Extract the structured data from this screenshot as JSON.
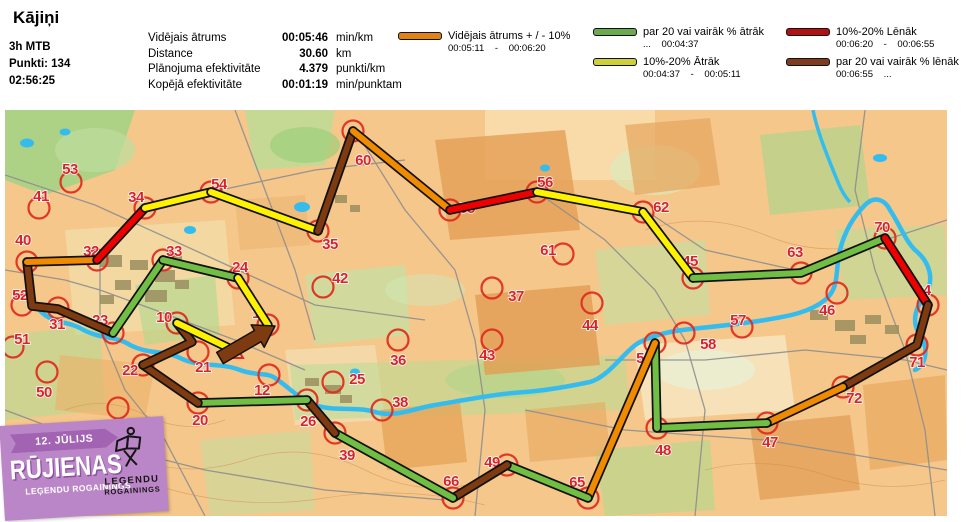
{
  "header": {
    "title": "Kājiņi",
    "class_label": "3h MTB",
    "points_label": "Punkti: 134",
    "time_label": "02:56:25",
    "stats": [
      {
        "label": "Vidējais ātrums",
        "value": "00:05:46",
        "unit": "min/km"
      },
      {
        "label": "Distance",
        "value": "30.60",
        "unit": "km"
      },
      {
        "label": "Plānojuma efektivitāte",
        "value": "4.379",
        "unit": "punkti/km"
      },
      {
        "label": "Kopējā efektivitāte",
        "value": "00:01:19",
        "unit": "min/punktam"
      }
    ]
  },
  "legend": {
    "items": [
      {
        "color": "#e08214",
        "label": "Vidējais ātrums + / - 10%",
        "range": "00:05:11 - 00:06:20"
      },
      {
        "color": "#6ca94f",
        "label": "par 20 vai vairāk % ātrāk",
        "range": "... 00:04:37"
      },
      {
        "color": "#cfcf3a",
        "label": "10%-20% Ātrāk",
        "range": "00:04:37 - 00:05:11"
      },
      {
        "color": "#b01212",
        "label": "10%-20% Lēnāk",
        "range": "00:06:20 - 00:06:55"
      },
      {
        "color": "#7e3b1e",
        "label": "par 20 vai vairāk % lēnāk",
        "range": "00:06:55 ..."
      }
    ]
  },
  "logo": {
    "date": "12. JŪLIJS",
    "title": "RŪJIENAS",
    "subtitle": "LEĢENDU ROGAININGS",
    "badge_line1": "LEĢENDU",
    "badge_line2": "ROGAININGS"
  },
  "map": {
    "colors": {
      "orange": "#f08a00",
      "green": "#70be44",
      "yellow": "#fff200",
      "red": "#ee0000",
      "brown": "#7e3a10"
    },
    "checkpoints": [
      {
        "n": "1",
        "cx": 263,
        "cy": 215,
        "lx": 251,
        "ly": 208
      },
      {
        "n": "10",
        "cx": 172,
        "cy": 213,
        "lx": 159,
        "ly": 212
      },
      {
        "n": "12",
        "cx": 264,
        "cy": 265,
        "lx": 257,
        "ly": 285
      },
      {
        "n": "20",
        "cx": 193,
        "cy": 293,
        "lx": 195,
        "ly": 315
      },
      {
        "n": "21",
        "cx": 193,
        "cy": 242,
        "lx": 198,
        "ly": 262
      },
      {
        "n": "22",
        "cx": 138,
        "cy": 255,
        "lx": 125,
        "ly": 265
      },
      {
        "n": "23",
        "cx": 108,
        "cy": 223,
        "lx": 95,
        "ly": 215
      },
      {
        "n": "24",
        "cx": 233,
        "cy": 168,
        "lx": 235,
        "ly": 162
      },
      {
        "n": "25",
        "cx": 328,
        "cy": 272,
        "lx": 352,
        "ly": 274
      },
      {
        "n": "26",
        "cx": 302,
        "cy": 290,
        "lx": 303,
        "ly": 316
      },
      {
        "n": "30",
        "cx": 113,
        "cy": 298,
        "lx": 116,
        "ly": 322
      },
      {
        "n": "31",
        "cx": 53,
        "cy": 198,
        "lx": 52,
        "ly": 219
      },
      {
        "n": "32",
        "cx": 92,
        "cy": 150,
        "lx": 86,
        "ly": 146
      },
      {
        "n": "33",
        "cx": 158,
        "cy": 150,
        "lx": 169,
        "ly": 146
      },
      {
        "n": "34",
        "cx": 140,
        "cy": 98,
        "lx": 131,
        "ly": 92
      },
      {
        "n": "35",
        "cx": 313,
        "cy": 121,
        "lx": 325,
        "ly": 139
      },
      {
        "n": "36",
        "cx": 393,
        "cy": 230,
        "lx": 393,
        "ly": 255
      },
      {
        "n": "37",
        "cx": 487,
        "cy": 178,
        "lx": 511,
        "ly": 191
      },
      {
        "n": "38",
        "cx": 377,
        "cy": 300,
        "lx": 395,
        "ly": 297
      },
      {
        "n": "39",
        "cx": 330,
        "cy": 323,
        "lx": 342,
        "ly": 350
      },
      {
        "n": "40",
        "cx": 22,
        "cy": 152,
        "lx": 18,
        "ly": 135
      },
      {
        "n": "41",
        "cx": 34,
        "cy": 98,
        "lx": 36,
        "ly": 91
      },
      {
        "n": "42",
        "cx": 318,
        "cy": 177,
        "lx": 335,
        "ly": 173
      },
      {
        "n": "43",
        "cx": 487,
        "cy": 230,
        "lx": 482,
        "ly": 250
      },
      {
        "n": "44",
        "cx": 587,
        "cy": 193,
        "lx": 585,
        "ly": 220
      },
      {
        "n": "45",
        "cx": 688,
        "cy": 168,
        "lx": 685,
        "ly": 156
      },
      {
        "n": "46",
        "cx": 832,
        "cy": 183,
        "lx": 822,
        "ly": 205
      },
      {
        "n": "47",
        "cx": 762,
        "cy": 313,
        "lx": 765,
        "ly": 337
      },
      {
        "n": "48",
        "cx": 652,
        "cy": 318,
        "lx": 658,
        "ly": 345
      },
      {
        "n": "49",
        "cx": 502,
        "cy": 355,
        "lx": 487,
        "ly": 357
      },
      {
        "n": "50",
        "cx": 42,
        "cy": 262,
        "lx": 39,
        "ly": 287
      },
      {
        "n": "51",
        "cx": 8,
        "cy": 237,
        "lx": 17,
        "ly": 234
      },
      {
        "n": "52",
        "cx": 17,
        "cy": 195,
        "lx": 15,
        "ly": 190
      },
      {
        "n": "53",
        "cx": 66,
        "cy": 72,
        "lx": 65,
        "ly": 64
      },
      {
        "n": "54",
        "cx": 206,
        "cy": 82,
        "lx": 214,
        "ly": 79
      },
      {
        "n": "55",
        "cx": 445,
        "cy": 100,
        "lx": 462,
        "ly": 103
      },
      {
        "n": "56",
        "cx": 532,
        "cy": 82,
        "lx": 540,
        "ly": 77
      },
      {
        "n": "57",
        "cx": 737,
        "cy": 217,
        "lx": 733,
        "ly": 215
      },
      {
        "n": "58",
        "cx": 679,
        "cy": 223,
        "lx": 703,
        "ly": 239
      },
      {
        "n": "59",
        "cx": 650,
        "cy": 233,
        "lx": 639,
        "ly": 253
      },
      {
        "n": "60",
        "cx": 348,
        "cy": 21,
        "lx": 358,
        "ly": 55
      },
      {
        "n": "61",
        "cx": 558,
        "cy": 144,
        "lx": 543,
        "ly": 145
      },
      {
        "n": "62",
        "cx": 638,
        "cy": 102,
        "lx": 656,
        "ly": 102
      },
      {
        "n": "63",
        "cx": 796,
        "cy": 163,
        "lx": 790,
        "ly": 147
      },
      {
        "n": "64",
        "cx": 923,
        "cy": 195,
        "lx": 918,
        "ly": 185
      },
      {
        "n": "65",
        "cx": 583,
        "cy": 388,
        "lx": 572,
        "ly": 377
      },
      {
        "n": "66",
        "cx": 448,
        "cy": 388,
        "lx": 446,
        "ly": 376
      },
      {
        "n": "70",
        "cx": 880,
        "cy": 128,
        "lx": 877,
        "ly": 122
      },
      {
        "n": "71",
        "cx": 912,
        "cy": 235,
        "lx": 912,
        "ly": 257
      },
      {
        "n": "72",
        "cx": 838,
        "cy": 277,
        "lx": 849,
        "ly": 293
      }
    ],
    "route": [
      {
        "c": "brown",
        "pts": [
          [
            22,
            152
          ],
          [
            27,
            196
          ],
          [
            53,
            199
          ],
          [
            108,
            223
          ]
        ]
      },
      {
        "c": "orange",
        "pts": [
          [
            22,
            152
          ],
          [
            92,
            150
          ]
        ]
      },
      {
        "c": "red",
        "pts": [
          [
            92,
            150
          ],
          [
            140,
            98
          ]
        ]
      },
      {
        "c": "yellow",
        "pts": [
          [
            140,
            98
          ],
          [
            206,
            82
          ]
        ]
      },
      {
        "c": "yellow",
        "pts": [
          [
            206,
            82
          ],
          [
            313,
            121
          ]
        ]
      },
      {
        "c": "brown",
        "pts": [
          [
            313,
            121
          ],
          [
            348,
            21
          ]
        ]
      },
      {
        "c": "orange",
        "pts": [
          [
            348,
            21
          ],
          [
            445,
            100
          ]
        ]
      },
      {
        "c": "red",
        "pts": [
          [
            445,
            100
          ],
          [
            532,
            82
          ]
        ]
      },
      {
        "c": "yellow",
        "pts": [
          [
            532,
            82
          ],
          [
            638,
            102
          ]
        ]
      },
      {
        "c": "yellow",
        "pts": [
          [
            638,
            102
          ],
          [
            688,
            168
          ]
        ]
      },
      {
        "c": "green",
        "pts": [
          [
            688,
            168
          ],
          [
            796,
            163
          ],
          [
            880,
            128
          ]
        ]
      },
      {
        "c": "red",
        "pts": [
          [
            880,
            128
          ],
          [
            923,
            195
          ]
        ]
      },
      {
        "c": "brown",
        "pts": [
          [
            923,
            195
          ],
          [
            912,
            235
          ],
          [
            838,
            277
          ]
        ]
      },
      {
        "c": "orange",
        "pts": [
          [
            838,
            277
          ],
          [
            762,
            313
          ]
        ]
      },
      {
        "c": "green",
        "pts": [
          [
            762,
            313
          ],
          [
            652,
            318
          ]
        ]
      },
      {
        "c": "green",
        "pts": [
          [
            652,
            318
          ],
          [
            650,
            233
          ]
        ]
      },
      {
        "c": "orange",
        "pts": [
          [
            650,
            233
          ],
          [
            583,
            388
          ]
        ]
      },
      {
        "c": "green",
        "pts": [
          [
            583,
            388
          ],
          [
            502,
            355
          ]
        ]
      },
      {
        "c": "brown",
        "pts": [
          [
            502,
            355
          ],
          [
            448,
            388
          ]
        ]
      },
      {
        "c": "green",
        "pts": [
          [
            448,
            388
          ],
          [
            330,
            323
          ]
        ]
      },
      {
        "c": "brown",
        "pts": [
          [
            330,
            323
          ],
          [
            302,
            290
          ]
        ]
      },
      {
        "c": "green",
        "pts": [
          [
            302,
            290
          ],
          [
            193,
            293
          ]
        ]
      },
      {
        "c": "brown",
        "pts": [
          [
            193,
            293
          ],
          [
            138,
            255
          ]
        ]
      },
      {
        "c": "brown",
        "pts": [
          [
            138,
            255
          ],
          [
            187,
            232
          ],
          [
            172,
            213
          ]
        ]
      },
      {
        "c": "yellow",
        "pts": [
          [
            172,
            213
          ],
          [
            228,
            240
          ]
        ]
      },
      {
        "c": "green",
        "pts": [
          [
            108,
            223
          ],
          [
            158,
            150
          ]
        ]
      },
      {
        "c": "green",
        "pts": [
          [
            158,
            150
          ],
          [
            233,
            168
          ]
        ]
      },
      {
        "c": "yellow",
        "pts": [
          [
            233,
            168
          ],
          [
            263,
            215
          ]
        ]
      }
    ],
    "start_triangle": "230,234 238,248 222,248",
    "finish_arrow": "211.7,242.4 249.4,220.5 246.2,214.9 270,216 259.2,237.3 256.0,231.7 218.3,253.6"
  }
}
